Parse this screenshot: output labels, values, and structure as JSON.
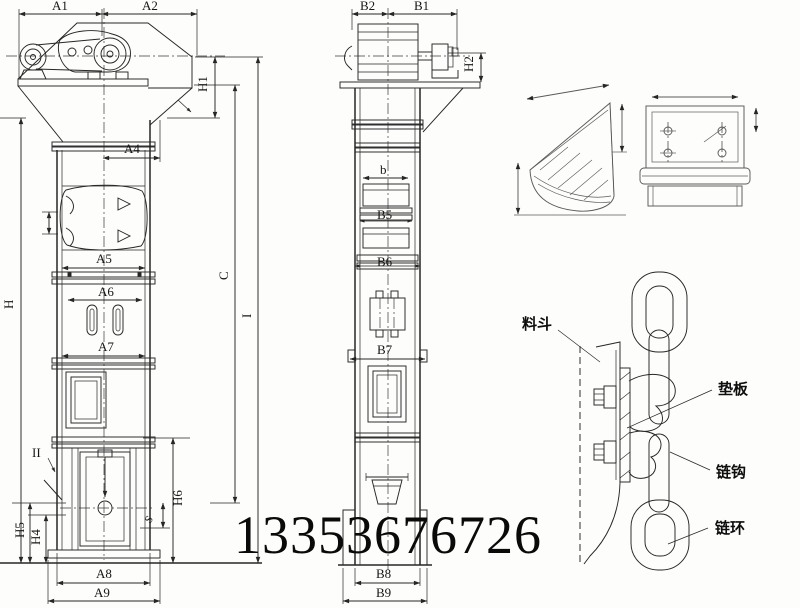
{
  "page": {
    "background": "#fdfdfb",
    "ink": "#262626",
    "detail_ink": "#5a5a5a"
  },
  "watermark": {
    "phone": "13353676726"
  },
  "front_view": {
    "title": "bucket elevator front view",
    "dims": {
      "a1": "A1",
      "a2": "A2",
      "h1": "H1",
      "a4": "A4",
      "a5": "A5",
      "a6": "A6",
      "a7": "A7",
      "h": "H",
      "c": "C",
      "i": "I",
      "ii": "II",
      "h5": "H5",
      "h4": "H4",
      "h6": "H6",
      "s": "S",
      "a8": "A8",
      "a9": "A9"
    }
  },
  "side_view": {
    "title": "bucket elevator side view",
    "dims": {
      "b2": "B2",
      "b1": "B1",
      "h2": "H2",
      "b": "b",
      "b5": "B5",
      "b6": "B6",
      "b7": "B7",
      "b8": "B8",
      "b9": "B9"
    }
  },
  "chain_detail": {
    "labels": {
      "bucket": "料斗",
      "pad_plate": "垫板",
      "chain_hook": "链钩",
      "chain_ring": "链环"
    }
  }
}
